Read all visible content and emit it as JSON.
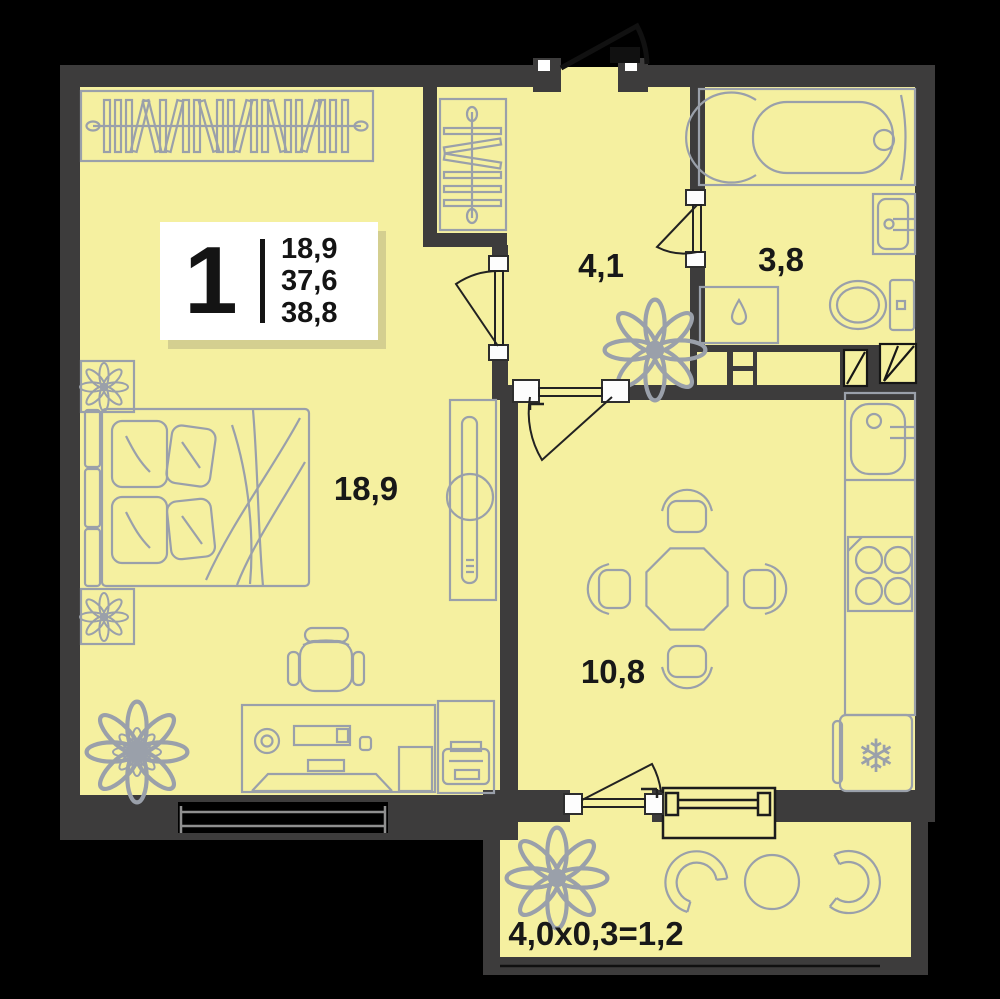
{
  "legend": {
    "rooms_count": "1",
    "living_area": "18,9",
    "area_no_balcony": "37,6",
    "total_area": "38,8"
  },
  "rooms": {
    "living": {
      "label": "18,9"
    },
    "hallway": {
      "label": "4,1"
    },
    "bathroom": {
      "label": "3,8"
    },
    "kitchen": {
      "label": "10,8"
    },
    "balcony": {
      "label": "4,0x0,3=1,2"
    }
  },
  "icons": {
    "snowflake": "snowflake-icon",
    "plant": "plant-icon",
    "water_drop": "water-drop-icon"
  },
  "colors": {
    "background": "#000000",
    "floor": "#f5f0a0",
    "wall": "#3d3c3c",
    "furniture_outline": "#9aa0aa",
    "door_line": "#1c1c1c",
    "text": "#181818",
    "legend_bg": "#ffffff",
    "legend_shadow": "#d4cf90"
  }
}
